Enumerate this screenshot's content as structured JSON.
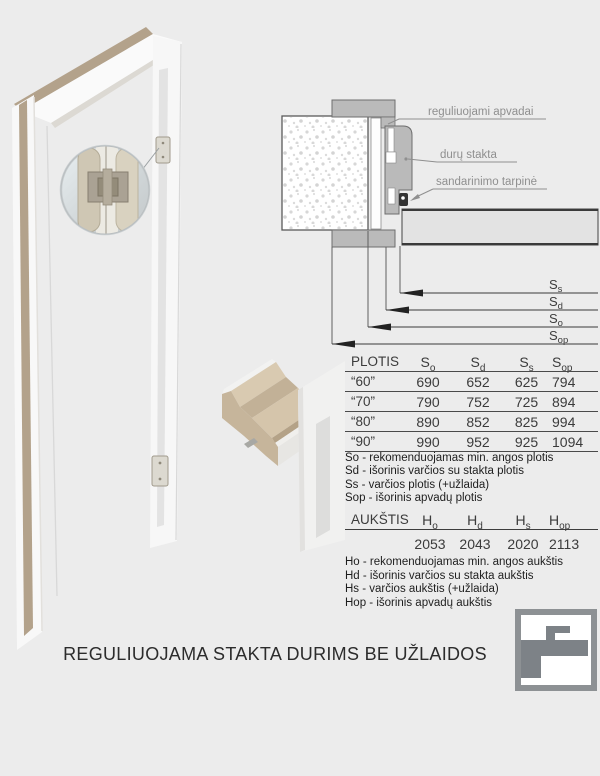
{
  "page": {
    "title": "REGULIUOJAMA STAKTA DURIMS BE UŽLAIDOS"
  },
  "colors": {
    "background": "#ececec",
    "diagram_gray": "#bababa",
    "wood_tan": "#b3a28b",
    "label_gray": "#8f8f8f",
    "text_dark": "#2c2c2c",
    "logo_gray": "#7d8287"
  },
  "diagram": {
    "label_trim": "reguliuojami apvadai",
    "label_frame": "durų stakta",
    "label_gasket": "sandarinimo tarpinė",
    "dims": [
      {
        "main": "S",
        "sub": "s"
      },
      {
        "main": "S",
        "sub": "d"
      },
      {
        "main": "S",
        "sub": "o"
      },
      {
        "main": "S",
        "sub": "op"
      }
    ]
  },
  "width_table": {
    "title": "PLOTIS",
    "columns": [
      {
        "main": "S",
        "sub": "o"
      },
      {
        "main": "S",
        "sub": "d"
      },
      {
        "main": "S",
        "sub": "s"
      },
      {
        "main": "S",
        "sub": "op"
      }
    ],
    "rows": [
      {
        "label": "“60”",
        "so": "690",
        "sd": "652",
        "ss": "625",
        "sop": "794"
      },
      {
        "label": "“70”",
        "so": "790",
        "sd": "752",
        "ss": "725",
        "sop": "894"
      },
      {
        "label": "“80”",
        "so": "890",
        "sd": "852",
        "ss": "825",
        "sop": "994"
      },
      {
        "label": "“90”",
        "so": "990",
        "sd": "952",
        "ss": "925",
        "sop": "1094"
      }
    ],
    "legend": [
      "So - rekomenduojamas min. angos plotis",
      "Sd - išorinis varčios su stakta plotis",
      "Ss - varčios plotis (+užlaida)",
      "Sop - išorinis apvadų plotis"
    ]
  },
  "height_table": {
    "title": "AUKŠTIS",
    "columns": [
      {
        "main": "H",
        "sub": "o"
      },
      {
        "main": "H",
        "sub": "d"
      },
      {
        "main": "H",
        "sub": "s"
      },
      {
        "main": "H",
        "sub": "op"
      }
    ],
    "values": [
      "2053",
      "2043",
      "2020",
      "2113"
    ],
    "legend": [
      "Ho - rekomenduojamas min. angos aukštis",
      "Hd - išorinis varčios su stakta aukštis",
      "Hs - varčios aukštis (+užlaida)",
      "Hop - išorinis apvadų aukštis"
    ]
  }
}
